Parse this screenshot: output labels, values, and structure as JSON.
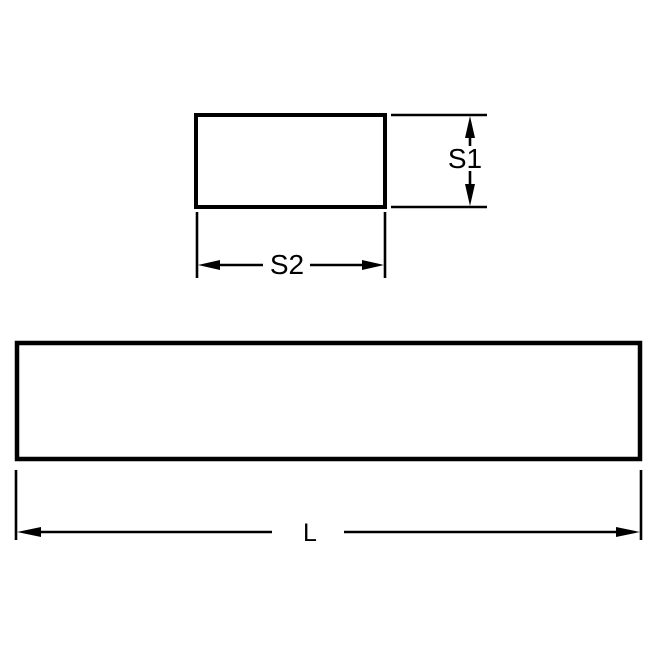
{
  "diagram": {
    "kind": "technical-dimension-drawing",
    "labels": {
      "s1": "S1",
      "s2": "S2",
      "length": "L"
    },
    "colors": {
      "line": "#000000",
      "background": "#ffffff"
    }
  }
}
